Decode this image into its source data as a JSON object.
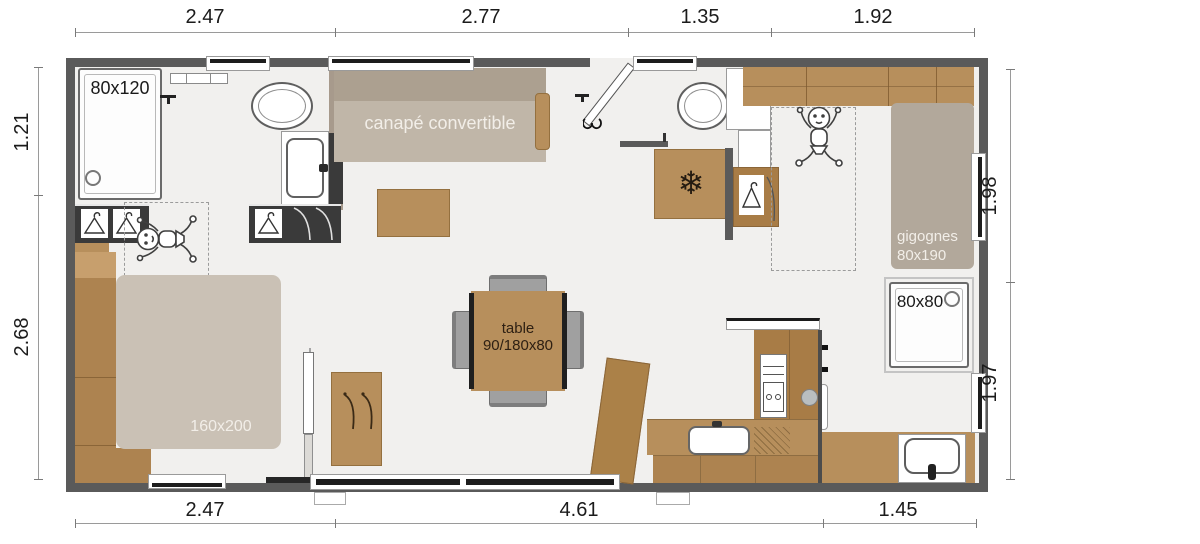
{
  "dims": {
    "top": [
      "2.47",
      "2.77",
      "1.35",
      "1.92"
    ],
    "bottom": [
      "2.47",
      "4.61",
      "1.45"
    ],
    "left": [
      "1.21",
      "2.68"
    ],
    "right": [
      "1.98",
      "1.97"
    ]
  },
  "labels": {
    "shower_large": "80x120",
    "sofa": "canapé convertible",
    "nesting_beds": "gigognes",
    "nesting_beds_size": "80x190",
    "shower_small": "80x80",
    "table": "table",
    "table_size": "90/180x80",
    "double_bed": "160x200"
  },
  "icons": {
    "snowflake": "❄",
    "fridge": "snowflake-icon",
    "nursery": "baby-icon",
    "wardrobe": "hanger-icon"
  },
  "colors": {
    "wall": "#5a5a5a",
    "floor": "#f1f0ee",
    "wood": "#b78f5c",
    "sofa_beige": "#c0b6a8",
    "bed_beige": "#cac1b5",
    "gigognes_beige": "#b2a89b",
    "dark_cabinet": "#3a3a3a",
    "taupe_wall": "#a79a8c",
    "glazing": "#1d1d1d"
  }
}
